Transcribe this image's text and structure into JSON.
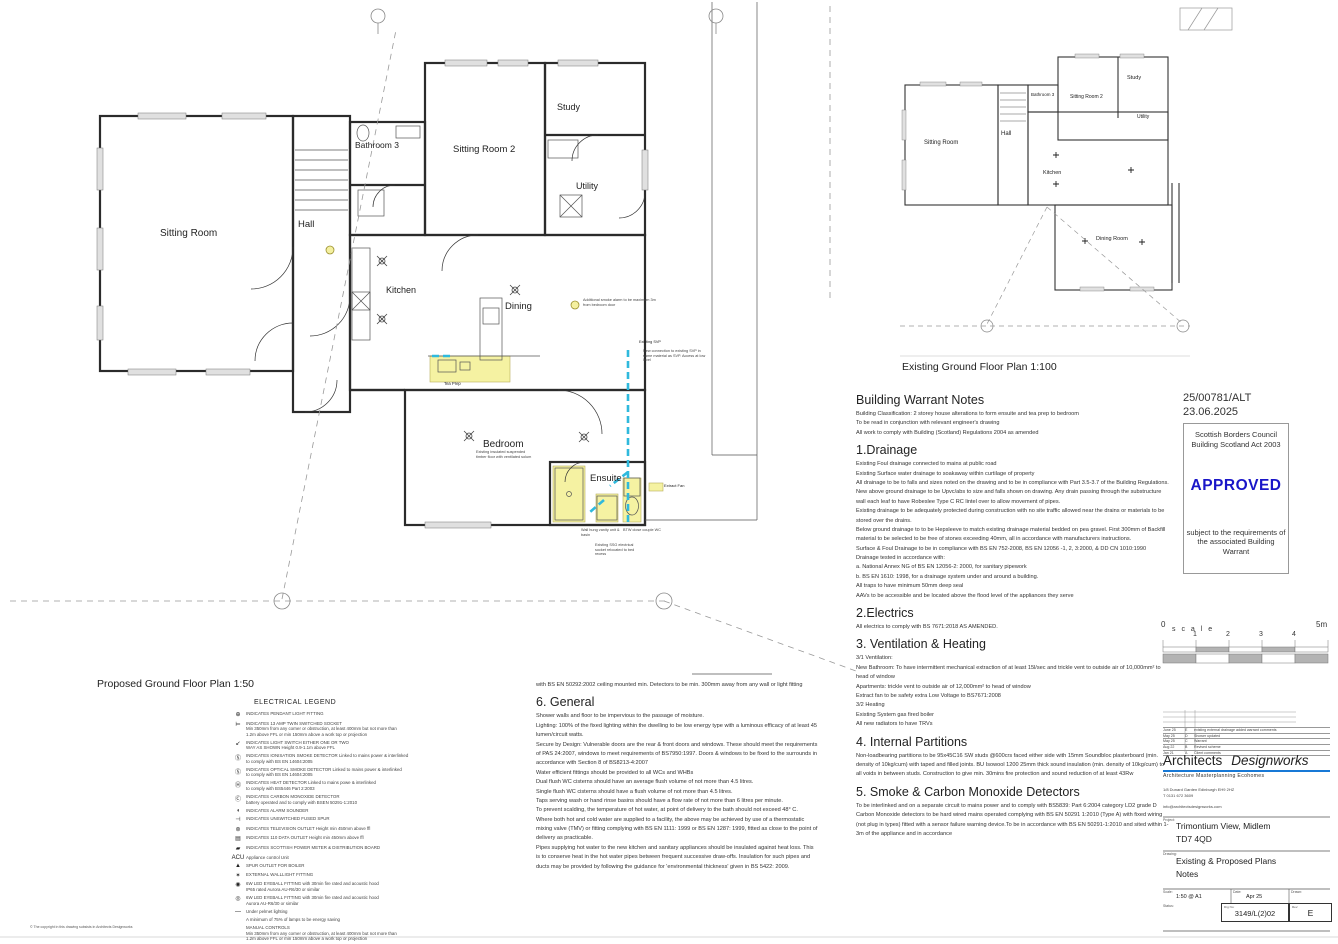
{
  "proposed": {
    "caption": "Proposed Ground Floor Plan 1:50",
    "rooms": {
      "sitting_room": "Sitting Room",
      "hall": "Hall",
      "bathroom3": "Bathroom 3",
      "sitting_room2": "Sitting Room 2",
      "study": "Study",
      "utility": "Utility",
      "kitchen": "Kitchen",
      "dining": "Dining",
      "bedroom": "Bedroom",
      "ensuite": "Ensuite"
    },
    "annotations": {
      "tea_prep": "Tea Prep",
      "extract_fan": "Extract Fan",
      "smoke_alarm": "Additional smoke alarm to be maximum 3m from bedroom door",
      "existing_svp": "Existing SVP",
      "svp_connection": "New connection to existing SVP in same material as SVP. Access at low level",
      "bedroom_floor": "Existing insulated suspended timber floor with ventilated solum",
      "vanity": "Wall hung vanity unit & basin",
      "wc": "BTW close couple WC",
      "socket": "Existing SSG electrical socket relocated to bed recess"
    }
  },
  "existing": {
    "caption": "Existing Ground Floor Plan 1:100",
    "rooms": {
      "sitting_room": "Sitting Room",
      "hall": "Hall",
      "bathroom3": "Bathroom 3",
      "sitting_room2": "Sitting Room 2",
      "study": "Study",
      "utility": "Utility",
      "kitchen": "Kitchen",
      "dining_room": "Dining Room"
    }
  },
  "warrant": {
    "heading": "Building Warrant Notes",
    "intro": [
      "Building Classification: 2 storey house alterations to form ensuite and tea prep to bedroom",
      "To be read in conjunction with relevant engineer's drawing",
      "All work to comply with Building (Scotland) Regulations 2004 as amended"
    ],
    "s1": {
      "heading": "1.Drainage",
      "paras": [
        "Existing Foul drainage connected to mains at public road",
        "Existing Surface water drainage to soakaway within curtilage of property",
        "All drainage to be to falls and sizes noted on the drawing and to be in compliance with Part 3.5-3.7 of the Building Regulations. New above ground drainage to be Upvc/abs to size and falls shown on drawing. Any drain passing through the substructure wall each leaf to have Robeslee Type C RC lintel over to allow movement of pipes.",
        "Existing drainage to be adequately protected during construction with no site traffic allowed near the drains or materials to be stored over the drains.",
        "Below ground drainage to  to be Hepsleeve to match existing drainage material bedded on pea gravel. First 300mm of Backfill material to be selected to be free of stones exceeding 40mm, all in accordance with manufacturers instructions.",
        "Surface & Foul Drainage to be in compliance with BS EN 752-2008, BS EN 12056 -1, 2, 3:2000, & DD CN 1010:1990",
        "Drainage  tested in accordance with:",
        "a. National Annex NG of BS EN 12056-2: 2000, for sanitary pipework",
        "b. BS EN 1610: 1998, for a drainage system under and around a building.",
        "All traps to have minimum 50mm deep seal",
        "AAVs to be accessible and be located above the flood level of the appliances they serve"
      ]
    },
    "s2": {
      "heading": "2.Electrics",
      "paras": [
        "All electrics to comply with BS 7671:2018 AS AMENDED."
      ]
    },
    "s3": {
      "heading": "3. Ventilation & Heating",
      "paras": [
        "3/1 Ventilation:",
        "New Bathroom:  To have intermittent mechanical extraction  of at least 15l/sec and trickle vent to outside air of 10,000mm² to head of window",
        "Apartments: trickle vent to outside air of 12,000mm² to head of window",
        "Extract fan to be safety extra Low Voltage to BS7671:2008",
        "3/2 Heating",
        "Existing System gas fired boiler",
        "All new radiators to have TRVs"
      ]
    },
    "s4": {
      "heading": "4. Internal Partitions",
      "paras": [
        "Non-loadbearing partitions to be 95x45C16 SW studs @600crs faced either side with 15mm Soundbloc plasterboard (min. density of 10kg/cum) with taped and filled joints. BU Isowool 1200 25mm thick sound insulation (min. density of 10kg/cum) to all voids in between studs. Construction to give min. 30mins fire protection and sound reduction of at least 43Rw"
      ]
    },
    "s5": {
      "heading": "5. Smoke & Carbon Monoxide Detectors",
      "paras": [
        "To be interlinked and on a separate circuit to mains power and to comply with BS5839: Part 6:2004 category LD2 grade D",
        "Carbon Monoxide detectors to be hard wired mains operated complying with BS EN 50291 1:2010 (Type A) with fixed wiring (not plug in types) fitted with a sensor failure warning device.To be in accordance with BS EN 50291-1:2010 and sited within 1-3m of the appliance and in accordance"
      ]
    }
  },
  "midnotes": {
    "continuation": [
      "with BS EN 50292:2002 ceiling mounted min. Detectors to be min. 300mm away from any wall or light fitting"
    ],
    "general_heading": "6. General",
    "general": [
      "Shower walls and floor to be impervious to the passage of moisture.",
      "Lighting: 100% of the fixed lighting within the dwelling to be low energy type with a luminous efficacy of at least 45 lumen/circuit watts.",
      "Secure by Design: Vulnerable doors are the rear & front doors and windows. These should meet the requirements of PAS 24:2007, windows to meet requirements of BS7950:1997. Doors & windows to be fixed to the surrounds in accordance with Section 8 of BS8213-4:2007",
      "Water efficient fittings should be provided to all WCs and WHBs",
      "Dual flush WC cisterns should have an average flush volume of not more than 4.5 litres.",
      "Single flush WC cisterns should have a flush volume of not more than 4.5 litres.",
      "Taps serving wash or hand rinse basins should have a flow rate of not more than 6 litres per minute.",
      "To prevent scalding, the temperature of hot water, at point of delivery to the bath should not exceed 48° C.",
      "Where both hot and cold water are supplied to a facility, the above may be achieved by use of a thermostatic mixing valve (TMV) or fitting complying with BS EN 1111: 1999 or BS EN 1287: 1999, fitted as close to the point of delivery as practicable.",
      "Pipes supplying hot water to the new kitchen and sanitary appliances should be insulated against heat loss. This is to conserve heat in the hot water pipes between frequent successive draw-offs. Insulation for such pipes and ducts may be provided by following the guidance for 'environmental thickness' given in BS 5422: 2009."
    ]
  },
  "legend": {
    "title": "ELECTRICAL LEGEND",
    "items": [
      {
        "sym": "⊕",
        "text": "INDICATES PENDANT LIGHT FITTING"
      },
      {
        "sym": "⊨",
        "text": "INDICATES  13 AMP TWIN SWITCHED SOCKET\nMin 350mm from any corner or obstruction, at least 400mm but not more than\n1.2m above FFL or min 150mm above a work top or projection"
      },
      {
        "sym": "↙",
        "text": "INDICATES LIGHT SWITCH EITHER ONE OR TWO\nWAY AS SHOWN Height 0.9-1.1m above FFL"
      },
      {
        "sym": "Ⓢ",
        "text": "INDICATES IONISATION SMOKE DETECTOR Linked to mains power & interlinked\nto comply with BS EN 14604:2005"
      },
      {
        "sym": "Ⓢ",
        "text": "INDICATES OPTICAL SMOKE DETECTOR Linked to mains power & interlinked\nto comply with BS EN 14604:2005"
      },
      {
        "sym": "Ⓗ",
        "text": "INDICATES HEAT DETECTOR Linked to mains powe & interlinked\nto comply with BS5446 Part 2:2003"
      },
      {
        "sym": "Ⓒ",
        "text": "INDICATES CARBON MONOXIDE DETECTOR\nbattery operated and to comply with BSEN 50291-1:2010"
      },
      {
        "sym": "◖",
        "text": "INDICATES ALARM SOUNDER"
      },
      {
        "sym": "⊣",
        "text": "INDICATES UNSWITCHED FUSED SPUR"
      },
      {
        "sym": "⊚",
        "text": "INDICATES TELEVISION OUTLET Height min 450mm above ffl"
      },
      {
        "sym": "▤",
        "text": "INDICATES 110 DATA OUTLET Height min 450mm above ffl"
      },
      {
        "sym": "▰",
        "text": "INDICATES SCOTTISH POWER METER & DISTRIBUTION BOARD"
      },
      {
        "sym": "ACU",
        "text": "Appliance control Unit"
      },
      {
        "sym": "▲",
        "text": "SPUR OUTLET FOR BOILER"
      },
      {
        "sym": "✶",
        "text": "EXTERNAL WALLLIGHT FITTING"
      },
      {
        "sym": "◉",
        "text": "6W LED EYEBALL FITTING with 30min fire rated  and acoustic hood\nIP65 rated Aurora AU-R6/30 or similar"
      },
      {
        "sym": "◎",
        "text": "6W LED EYEBALL FITTING with 30min fire rated  and acoustic hood\nAurora AU-R6/30 or similar"
      },
      {
        "sym": "—",
        "text": "Under pelmet lighting"
      },
      {
        "sym": "",
        "text": "A minimum of 75% of lamps to be energy saving"
      },
      {
        "sym": "",
        "text": "MANUAL CONTROLS\nMin 350mm from any corner or obstruction, at least 400mm but not more than\n1.2m above FFL or min 150mm above a work top or projection"
      }
    ]
  },
  "stamp": {
    "ref": "25/00781/ALT",
    "date": "23.06.2025",
    "council_line1": "Scottish Borders Council",
    "council_line2": "Building Scotland Act 2003",
    "approved": "APPROVED",
    "footer": "subject to the requirements of the associated Building Warrant",
    "approved_color": "#1a16c8"
  },
  "scalebar": {
    "zero": "0",
    "label": "s c a l e",
    "tick1": "1",
    "tick2": "2",
    "tick3": "3",
    "tick4": "4",
    "max": "5m"
  },
  "titleblock": {
    "revisions": [
      {
        "date": "June 25",
        "rev": "E",
        "desc": "existing external drainage added warrant comments"
      },
      {
        "date": "May 25",
        "rev": "D",
        "desc": "Shower updated"
      },
      {
        "date": "May 25",
        "rev": "C",
        "desc": "Warrant"
      },
      {
        "date": "Aug 22",
        "rev": "B",
        "desc": "Revised scheme"
      },
      {
        "date": "Jan 21",
        "rev": "A",
        "desc": "Client comments"
      }
    ],
    "brand1": "Architects",
    "brand2": "Designworks",
    "tagline": "Architecture  Masterplanning  Ecohomes",
    "address": "1/8 Dunard Garden  Edinburgh  EH9 2HZ",
    "phone": "T 0131 672 3609",
    "email": "info@architectsdesignworks.com",
    "project_label": "Project:",
    "project_line1": "Trimontium View, Midlem",
    "project_line2": "TD7 4QD",
    "drawing_label": "Drawing:",
    "drawing_line1": "Existing & Proposed Plans",
    "drawing_line2": "Notes",
    "scale_label": "Scale:",
    "scale_value": "1:50 @ A1",
    "date_label": "Date:",
    "date_value": "Apr 25",
    "drawn_label": "Drawn:",
    "status_label": "Status:",
    "drgno_label": "Drg No:",
    "drgno_value": "3149/L(2)02",
    "rev_label": "Rev:",
    "rev_value": "E",
    "accent_color": "#1879d6"
  },
  "copyright": "© The copyright in this drawing subsists in Architects Designworks"
}
